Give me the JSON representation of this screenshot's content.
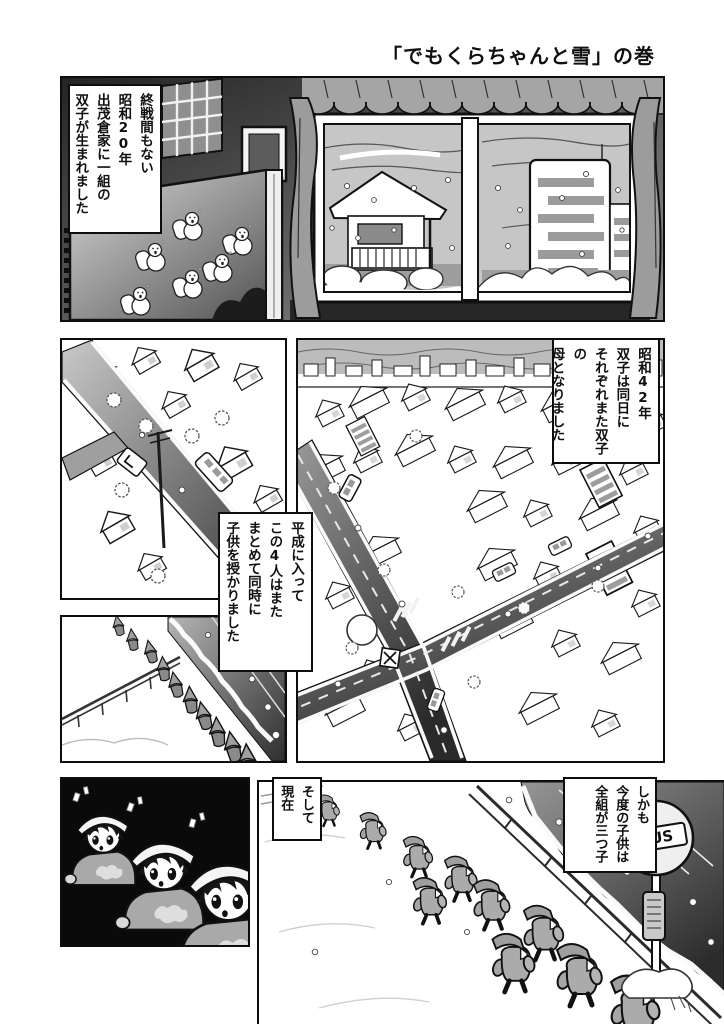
{
  "page_title": "「でもくらちゃんと雪」の巻",
  "captions": {
    "birth": [
      "終戦間もない",
      "昭和20年",
      "出茂倉家に一組の",
      "双子が生まれました"
    ],
    "showa42": [
      "昭和42年",
      "双子は同日に",
      "それぞれまた双子の",
      "母となりました"
    ],
    "heisei": [
      "平成に入って",
      "この4人はまた",
      "まとめて同時に",
      "子供を授かりました"
    ],
    "now": [
      "そして",
      "現在"
    ],
    "triplets": [
      "しかも",
      "今度の子供は",
      "全組が三つ子"
    ]
  },
  "signs": {
    "bus_stop": "BUS"
  },
  "colors": {
    "ink": "#101010",
    "paper": "#ffffff",
    "tone_light": "#c6c6c6",
    "tone_mid": "#a9a9a9",
    "tone_dark": "#2e2e2e"
  }
}
